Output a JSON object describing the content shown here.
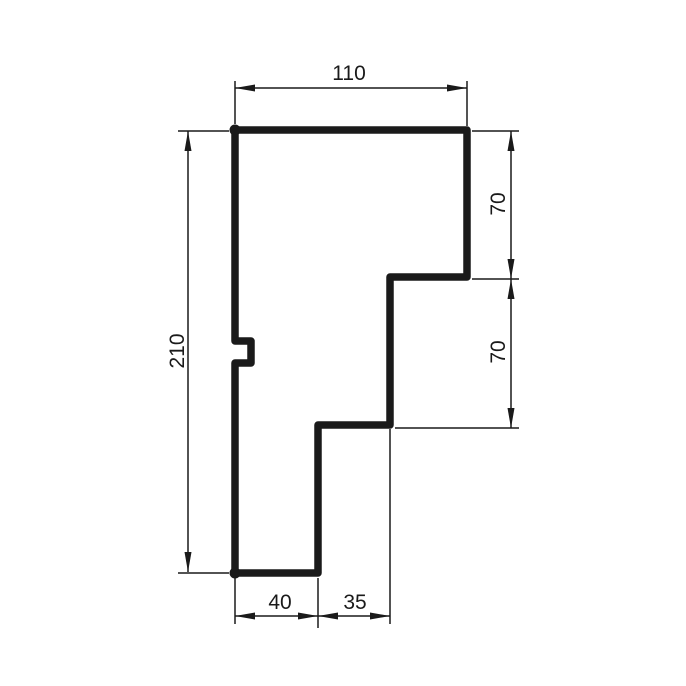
{
  "background_color": "#ffffff",
  "ink_color": "#1a1a1a",
  "drawing": {
    "type": "technical-profile-section",
    "profile": {
      "path": "M235 130 H467 V277 H390 V425 H318 V573 H235 V363 H251 V341 H235 Z",
      "stroke_width": 7.5,
      "node_dots": [
        {
          "cx": 235,
          "cy": 130,
          "r": 5.5
        },
        {
          "cx": 235,
          "cy": 573,
          "r": 5.5
        }
      ]
    },
    "arrow": {
      "length": 20,
      "half_width": 3.5
    },
    "dimensions": [
      {
        "id": "top-width",
        "label": "110",
        "line": [
          235,
          88,
          467,
          88
        ],
        "arrows": [
          {
            "tip": [
              235,
              88
            ],
            "dir": "left"
          },
          {
            "tip": [
              467,
              88
            ],
            "dir": "right"
          }
        ],
        "extensions": [
          [
            235,
            81,
            235,
            124
          ],
          [
            467,
            81,
            467,
            126
          ]
        ],
        "text": {
          "x": 349,
          "y": 80,
          "rotate": 0
        }
      },
      {
        "id": "total-height",
        "label": "210",
        "line": [
          188,
          131,
          188,
          572
        ],
        "arrows": [
          {
            "tip": [
              188,
              131
            ],
            "dir": "up"
          },
          {
            "tip": [
              188,
              572
            ],
            "dir": "down"
          }
        ],
        "extensions": [
          [
            178,
            131,
            229,
            131
          ],
          [
            178,
            573,
            229,
            573
          ]
        ],
        "text": {
          "x": 184,
          "y": 351,
          "rotate": -90
        }
      },
      {
        "id": "upper-step-height",
        "label": "70",
        "line": [
          511,
          131,
          511,
          279
        ],
        "arrows": [
          {
            "tip": [
              511,
              131
            ],
            "dir": "up"
          },
          {
            "tip": [
              511,
              279
            ],
            "dir": "down"
          }
        ],
        "extensions": [
          [
            472,
            131,
            519,
            131
          ],
          [
            472,
            279,
            519,
            279
          ]
        ],
        "text": {
          "x": 505,
          "y": 204,
          "rotate": -90
        }
      },
      {
        "id": "lower-step-height",
        "label": "70",
        "line": [
          511,
          279,
          511,
          428
        ],
        "arrows": [
          {
            "tip": [
              511,
              279
            ],
            "dir": "up"
          },
          {
            "tip": [
              511,
              428
            ],
            "dir": "down"
          }
        ],
        "extensions": [
          [
            395,
            428,
            519,
            428
          ]
        ],
        "text": {
          "x": 505,
          "y": 352,
          "rotate": -90
        }
      },
      {
        "id": "bottom-width-left",
        "label": "40",
        "line": [
          235,
          616,
          318,
          616
        ],
        "arrows": [
          {
            "tip": [
              235,
              616
            ],
            "dir": "left"
          },
          {
            "tip": [
              318,
              616
            ],
            "dir": "right"
          }
        ],
        "extensions": [
          [
            235,
            578,
            235,
            624
          ],
          [
            318,
            578,
            318,
            628
          ]
        ],
        "text": {
          "x": 280,
          "y": 609,
          "rotate": 0
        }
      },
      {
        "id": "bottom-width-right",
        "label": "35",
        "line": [
          318,
          616,
          390,
          616
        ],
        "arrows": [
          {
            "tip": [
              318,
              616
            ],
            "dir": "left"
          },
          {
            "tip": [
              390,
              616
            ],
            "dir": "right"
          }
        ],
        "extensions": [
          [
            390,
            429,
            390,
            624
          ]
        ],
        "text": {
          "x": 355,
          "y": 609,
          "rotate": 0
        }
      }
    ]
  }
}
